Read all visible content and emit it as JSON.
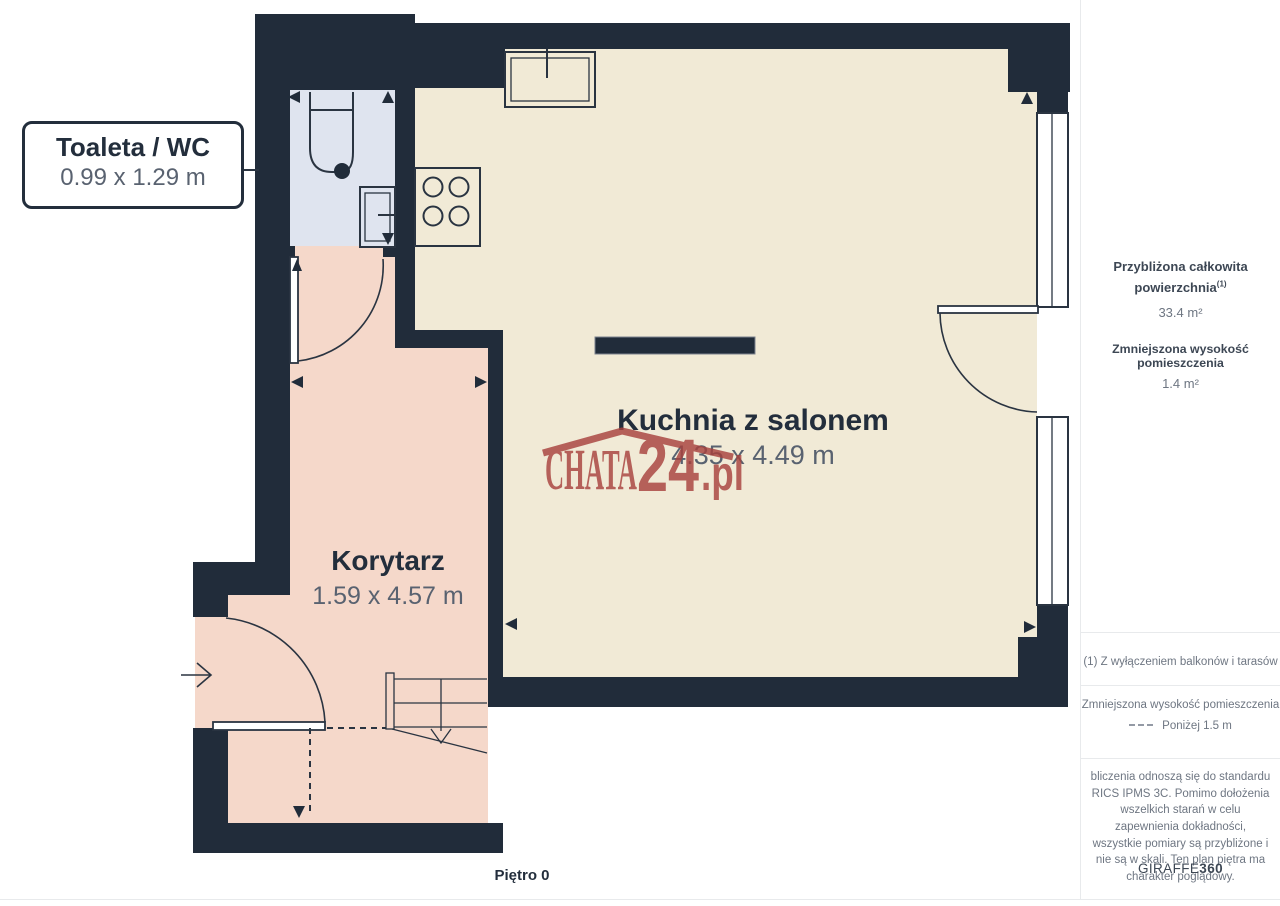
{
  "page": {
    "floor_label": "Piętro 0"
  },
  "rooms": {
    "toilet": {
      "name": "Toaleta / WC",
      "dims": "0.99 x 1.29 m"
    },
    "kitchen_living": {
      "name": "Kuchnia z salonem",
      "dims": "4.35 x 4.49 m"
    },
    "corridor": {
      "name": "Korytarz",
      "dims": "1.59 x 4.57 m"
    }
  },
  "watermark": {
    "brand": "CHATA",
    "number": "24",
    "suffix": ".pl"
  },
  "sidebar": {
    "approx_area_label_line1": "Przybliżona całkowita",
    "approx_area_label_line2": "powierzchnia",
    "approx_area_footnote_marker": "(1)",
    "approx_area_value": "33.4 m²",
    "reduced_height_label": "Zmniejszona wysokość pomieszczenia",
    "reduced_height_value": "1.4 m²",
    "footnote": "(1) Z wyłączeniem balkonów i tarasów",
    "legend_label": "Zmniejszona wysokość pomieszczenia",
    "legend_item": "Poniżej 1.5 m",
    "disclaimer": "bliczenia odnoszą się do standardu RICS IPMS 3C. Pomimo dołożenia wszelkich starań w celu zapewnienia dokładności, wszystkie pomiary są przybliżone i nie są w skali. Ten plan piętra ma charakter poglądowy.",
    "brand_name": "GIRAFFE",
    "brand_suffix": "360"
  },
  "colors": {
    "wall": "#212c3a",
    "line": "#2a3441",
    "room_main": "#f1ead6",
    "room_corridor": "#f5d8ca",
    "room_toilet": "#dfe4ef",
    "watermark": "#a8423e",
    "text_dark": "#232e3c",
    "text_gray": "#596270",
    "sidebar_text": "#3d4754",
    "sidebar_muted": "#6e7682",
    "divider": "#e8eaec"
  }
}
